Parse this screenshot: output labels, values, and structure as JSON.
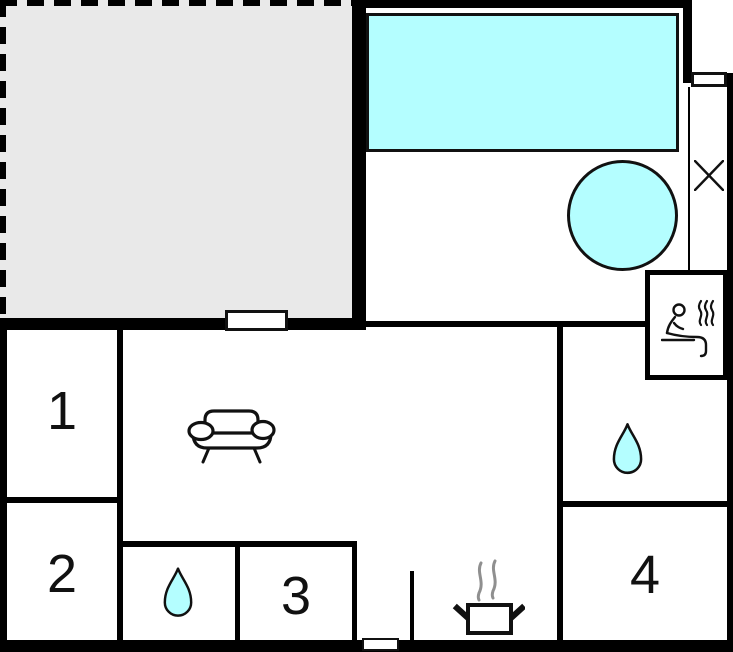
{
  "plan": {
    "type": "holiday-home-floor-plan",
    "rooms": [
      {
        "label": "1"
      },
      {
        "label": "2"
      },
      {
        "label": "3"
      },
      {
        "label": "4"
      }
    ],
    "icons": [
      "sofa-icon",
      "sauna-person-steam-icon",
      "water-drop-icon",
      "water-drop-icon",
      "cooking-pot-steam-icon",
      "cross-icon"
    ],
    "features": [
      "terrace-dashed",
      "pool-rectangle",
      "hot-tub-circle",
      "sauna-cabin",
      "door-opening-terrace",
      "door-opening-bottom",
      "window-top-right"
    ],
    "colors": {
      "water": "#b4feff",
      "terrace": "#e9e9e9",
      "wall": "#000000",
      "line": "#111111",
      "steam": "#8f8f8f"
    }
  }
}
